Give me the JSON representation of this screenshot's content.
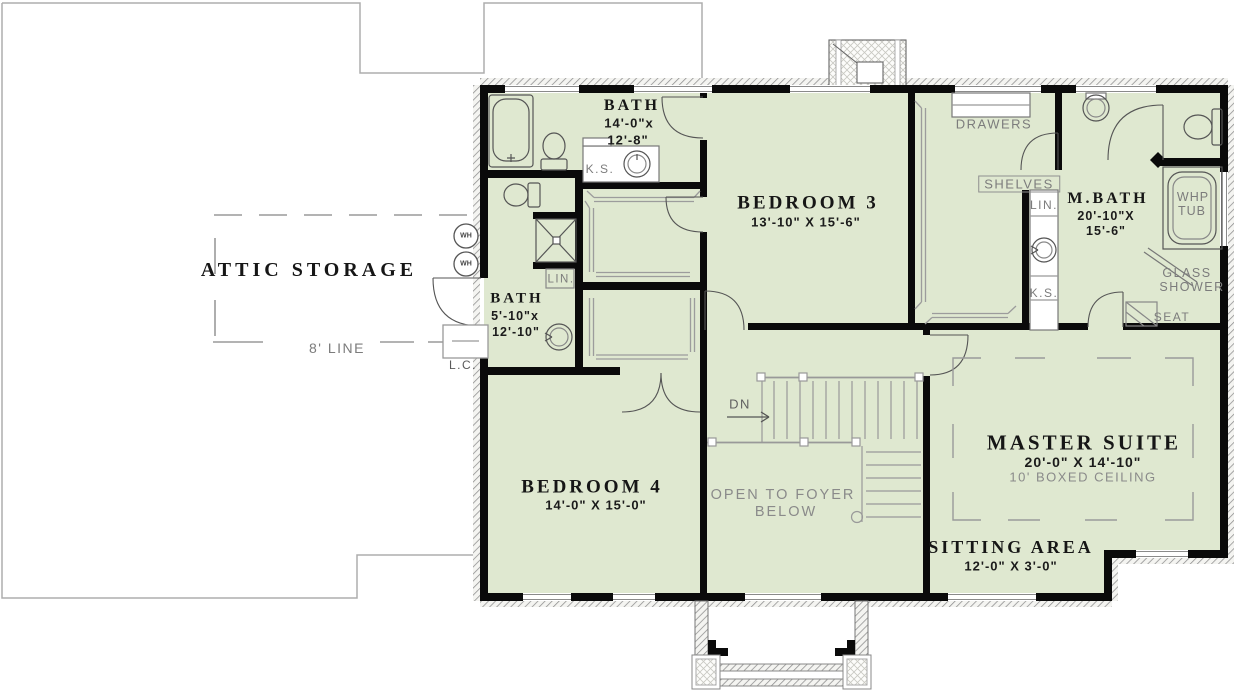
{
  "colors": {
    "floor": "#dfe8d0",
    "wall": "#000000",
    "annotation": "#7c7c7c",
    "label": "#161616"
  },
  "attic": {
    "label": "ATTIC STORAGE",
    "ceiling_line_label": "8' LINE",
    "water_heater_label": "WH",
    "laundry_chute_label": "L.C."
  },
  "rooms": {
    "bath_upper": {
      "name": "BATH",
      "dim_line1": "14'-0\"x",
      "dim_line2": "12'-8\"",
      "knee_space_label": "K.S."
    },
    "bedroom3": {
      "name": "BEDROOM 3",
      "dims": "13'-10\" X 15'-6\""
    },
    "master_closet": {
      "drawers_label": "DRAWERS",
      "shelves_label": "SHELVES",
      "linen_label": "LIN.",
      "knee_space_label": "K.S."
    },
    "master_bath": {
      "name": "M.BATH",
      "dim_line1": "20'-10\"X",
      "dim_line2": "15'-6\"",
      "tub_label_line1": "WHP",
      "tub_label_line2": "TUB",
      "shower_label_line1": "GLASS",
      "shower_label_line2": "SHOWER",
      "seat_label": "SEAT"
    },
    "bath_lower": {
      "name": "BATH",
      "dim_line1": "5'-10\"x",
      "dim_line2": "12'-10\"",
      "linen_label": "LIN."
    },
    "bedroom4": {
      "name": "BEDROOM 4",
      "dims": "14'-0\" X 15'-0\""
    },
    "stairs": {
      "down_label": "DN"
    },
    "foyer": {
      "line1": "OPEN TO FOYER",
      "line2": "BELOW"
    },
    "master_suite": {
      "name": "MASTER SUITE",
      "dims": "20'-0\" X 14'-10\"",
      "ceiling_note": "10' BOXED CEILING"
    },
    "sitting_area": {
      "name": "SITTING AREA",
      "dims": "12'-0\" X 3'-0\""
    }
  }
}
